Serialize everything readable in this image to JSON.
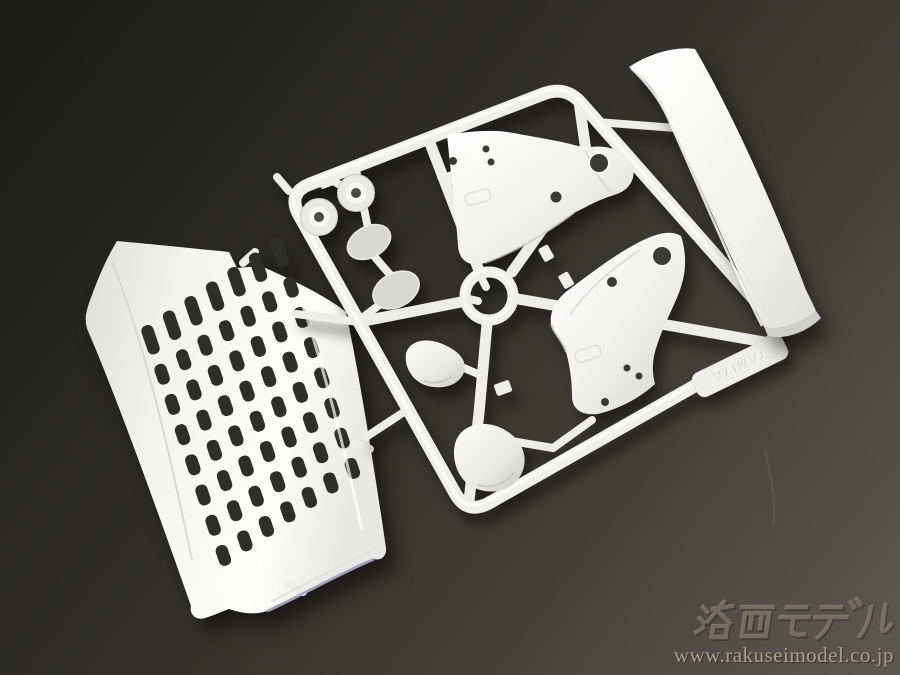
{
  "scene": {
    "subject": "White plastic model kit sprue (parts tree) photographed on a dark gray studio background",
    "background": {
      "top_left": "#1a1a18",
      "middle": "#31302c",
      "bottom_right": "#5b5951"
    },
    "plastic": {
      "base": "#f1f1ef",
      "highlight": "#ffffff",
      "shadow": "#c6c6c4",
      "slot_dark": "#2e2e2c"
    }
  },
  "sprue": {
    "tag_text": "TAMIYA",
    "parts": [
      {
        "id": "grille",
        "label": "truck front grille panel"
      },
      {
        "id": "spoiler",
        "label": "curved air-dam blade"
      },
      {
        "id": "fender-upper",
        "label": "fender shell part (upper)"
      },
      {
        "id": "fender-lower",
        "label": "fender shell part (lower)"
      },
      {
        "id": "mirror-face-1",
        "label": "small oval mirror face"
      },
      {
        "id": "mirror-face-2",
        "label": "large oval mirror face"
      },
      {
        "id": "mirror-shell-upper",
        "label": "small mirror housing shell"
      },
      {
        "id": "mirror-shell-lower",
        "label": "large mirror housing shell"
      },
      {
        "id": "grommet-1",
        "label": "round grommet cap"
      },
      {
        "id": "grommet-2",
        "label": "round grommet cap"
      },
      {
        "id": "hub-ring",
        "label": "central sprue ring"
      }
    ]
  },
  "grille_grid": {
    "cols": 7,
    "rows": 8,
    "origin": [
      152,
      344
    ],
    "col_step": [
      21.5,
      -14.5
    ],
    "row_step": [
      10.2,
      30.2
    ],
    "slot_len": 21,
    "slot_w": 12.5,
    "tip_extra": 9,
    "color": "#2e2e2c"
  },
  "watermark": {
    "logo_text": "洛西モデル",
    "url_text": "www.rakuseimodel.co.jp",
    "logo_color": "#9a9488",
    "url_color": "#b3ac9a"
  }
}
